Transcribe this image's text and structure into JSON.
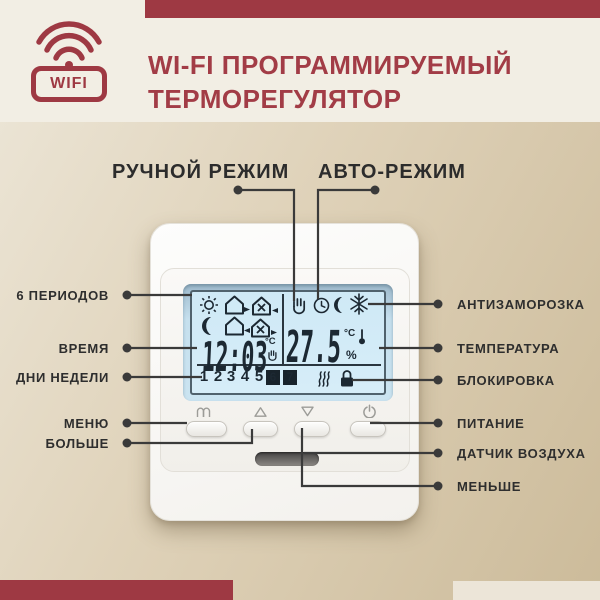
{
  "header": {
    "badge_label": "WIFI",
    "title_line1": "WI-FI ПРОГРАММИРУЕМЫЙ",
    "title_line2": "ТЕРМОРЕГУЛЯТОР"
  },
  "mode_labels": {
    "manual": "РУЧНОЙ РЕЖИМ",
    "auto": "АВТО-РЕЖИМ"
  },
  "callouts": {
    "left": [
      "6 ПЕРИОДОВ",
      "ВРЕМЯ",
      "ДНИ НЕДЕЛИ",
      "МЕНЮ",
      "БОЛЬШЕ"
    ],
    "right": [
      "АНТИЗАМОРОЗКА",
      "ТЕМПЕРАТУРА",
      "БЛОКИРОВКА",
      "ПИТАНИЕ",
      "ДАТЧИК ВОЗДУХА",
      "МЕНЬШЕ"
    ]
  },
  "thermostat": {
    "display": {
      "time": "12:03",
      "time_unit": "°C",
      "temperature": "27.5",
      "temperature_unit": "°C",
      "humidity_symbol": "%",
      "days": [
        "1",
        "2",
        "3",
        "4",
        "5",
        "6",
        "7"
      ],
      "active_days": [
        "6",
        "7"
      ],
      "period_icons": [
        "sun-icon",
        "house-leave-icon",
        "house-work-arrive-icon",
        "moon-icon",
        "house-return-icon",
        "house-work-leave-icon"
      ],
      "status_icons": [
        "hand-manual-icon",
        "clock-auto-icon",
        "moon-night-icon",
        "snowflake-antifreeze-icon"
      ],
      "indicator_icons": [
        "heating-waves-icon",
        "lock-icon"
      ]
    },
    "buttons": [
      {
        "icon": "menu-book-icon"
      },
      {
        "icon": "arrow-up-icon"
      },
      {
        "icon": "arrow-down-icon"
      },
      {
        "icon": "power-icon"
      }
    ],
    "vent": "air-sensor-slot"
  },
  "colors": {
    "accent_red": "#9E3943",
    "label_text": "#2E2E2E",
    "lcd_background": "#D2EBF7",
    "background_top": "#F2EEE4",
    "background_bottom": "#CBB995"
  }
}
